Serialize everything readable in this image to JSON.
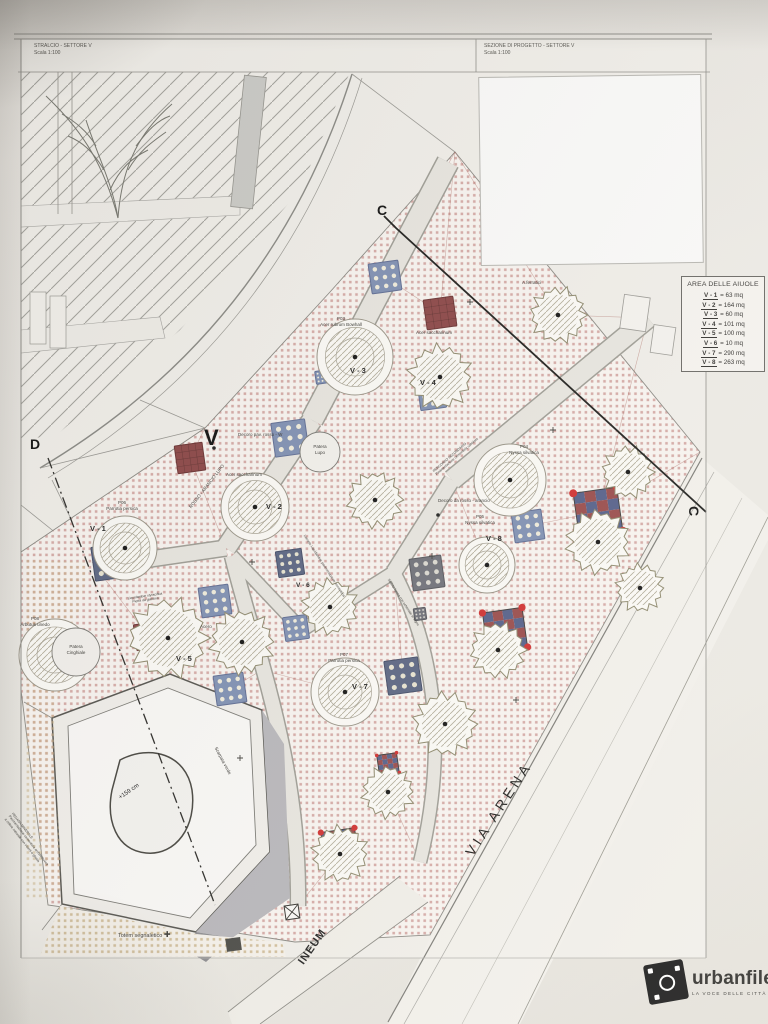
{
  "header": {
    "left_title": "STRALCIO - SETTORE V",
    "left_scale": "Scala 1:100",
    "right_title": "SEZIONE DI PROGETTO - SETTORE V",
    "right_scale": "Scala 1:100"
  },
  "legend": {
    "title": "AREA DELLE AIUOLE",
    "items": [
      {
        "label": "V - 1",
        "value": "= 63 mq"
      },
      {
        "label": "V - 2",
        "value": "= 164 mq"
      },
      {
        "label": "V - 3",
        "value": "= 60 mq"
      },
      {
        "label": "V - 4",
        "value": "= 101 mq"
      },
      {
        "label": "V - 5",
        "value": "= 100 mq"
      },
      {
        "label": "V - 6",
        "value": "= 10 mq"
      },
      {
        "label": "V - 7",
        "value": "= 290 mq"
      },
      {
        "label": "V - 8",
        "value": "= 263 mq"
      }
    ]
  },
  "plan": {
    "section_marks": {
      "c": "C",
      "d": "D"
    },
    "sector_mark": "V",
    "sector_note": "ROSSO - ARANCIO LUPO",
    "street": "VIA ARENA",
    "street_fragment": "INEUM",
    "labels": {
      "p03_code": "P03",
      "p03_species": "Acer rubrum Bowhall",
      "acer_top": "Acer saccharinum",
      "acer_mid": "Acer saccharinum",
      "v1": "V - 1",
      "v2": "V - 2",
      "v3": "V - 3",
      "v4": "V - 4",
      "v5": "V - 5",
      "v6": "V - 6",
      "v7": "V - 7",
      "v8": "V - 8",
      "p04_code": "P04",
      "p04_species": "Nyssa silvatica",
      "p05_code": "P05",
      "p05_species": "Nyssa silvatica",
      "p06_code": "P06",
      "p06_species": "Parrotia persica",
      "p07_code": "P07",
      "p07_species": "Parrotia persica",
      "p08_code": "P08",
      "p08_species": "Arbutus unedo",
      "patera_lupo_1": "Patera",
      "patera_lupo_2": "Lupo",
      "patera_cinghiale_1": "Patera",
      "patera_cinghiale_2": "Cinghiale",
      "tree_topright": "A.ferratici",
      "note_1": "Decoro pav. rosso - W",
      "note_2": "Decoro da rosso - arancio",
      "percorso_1": "PERCORSO SECONDARIO",
      "percorso_2": "Pavimentazione cementizia sabbiata",
      "lecceto": "Lecceto Liquidambar pavimentazione cementizia",
      "seduta": "Seduta lignea con schienale in legno",
      "liquidambar": "Liquidambar styraciflua",
      "pietra_giardino": "Pietra da giardino",
      "acero": "Acero",
      "scarpata": "Scarpata verde",
      "quota": "+159 cm",
      "pedana_1": "PEDANA MINERALE",
      "pedana_2": "Pavimentazione cementizia architettonica",
      "pedana_3": "a colore naturale con inserti e ghiaia",
      "totem": "Totem segnaletico",
      "totem_mark": "✚"
    }
  },
  "logo": {
    "name": "urbanfile",
    "tagline": "LA VOCE DELLE CITTÀ"
  },
  "colors": {
    "park_dots": "#c9908c",
    "gold_dots": "#cbb389",
    "bed_blue": "#8091b4",
    "bed_navy": "#5b6683",
    "bed_maroon": "#8d4747",
    "bed_check_red": "#9a4b4b",
    "bed_check_blue": "#55608a",
    "corner_dot_red": "#d23030",
    "paper": "#efede8"
  }
}
